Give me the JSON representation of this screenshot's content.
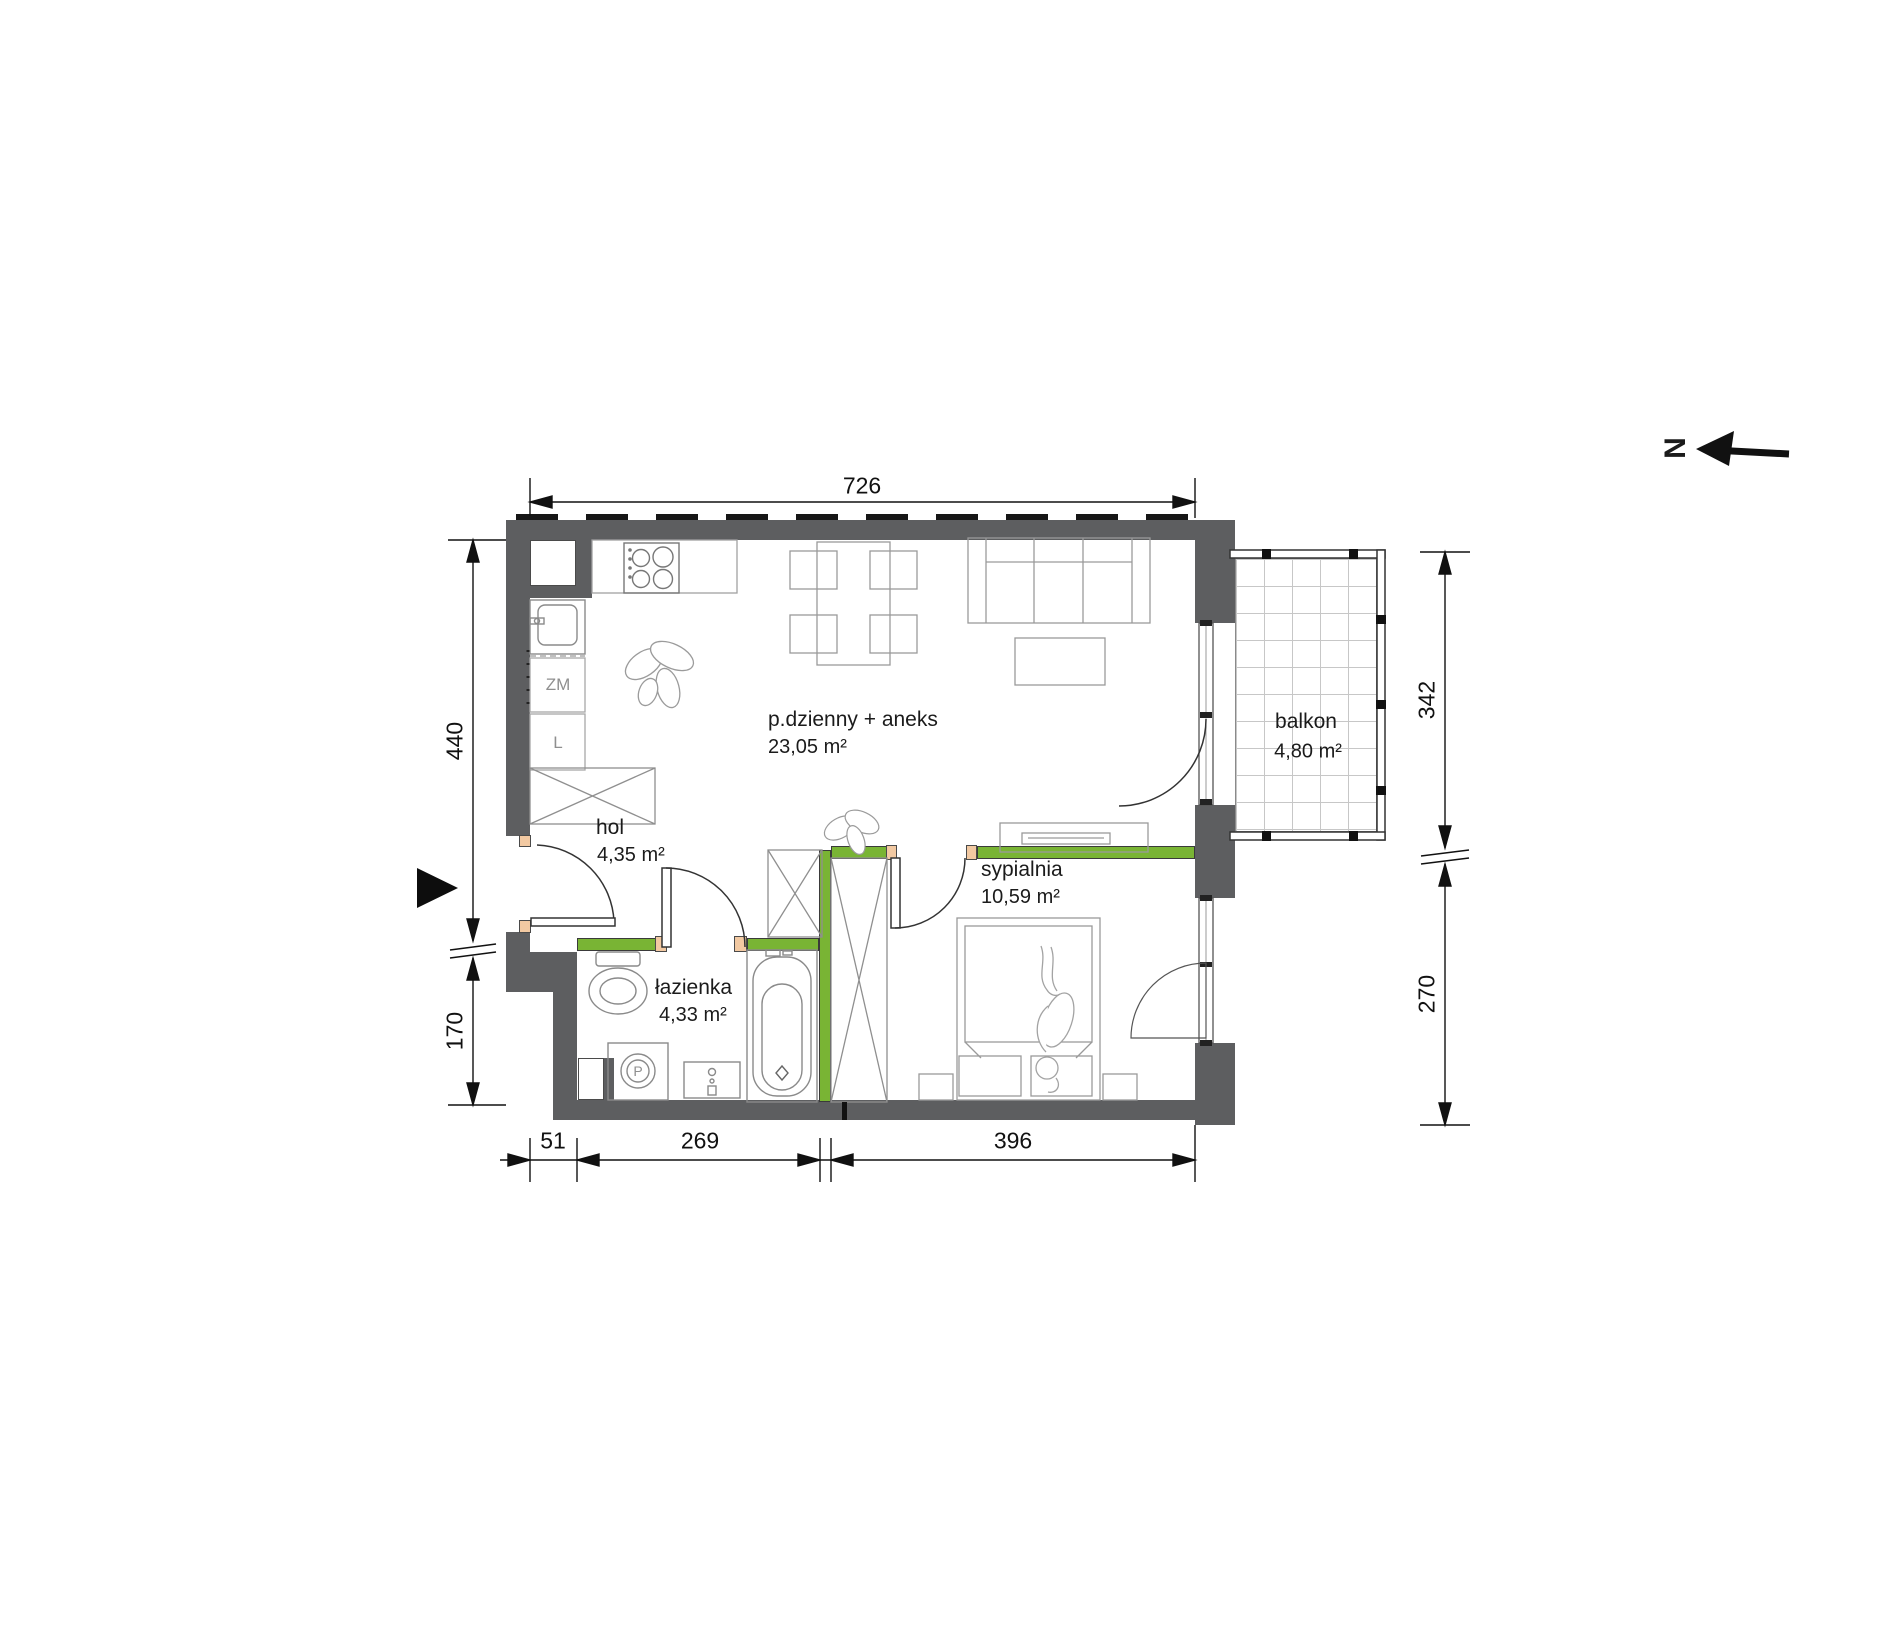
{
  "compass": {
    "north": "N"
  },
  "rooms": [
    {
      "id": "living",
      "name": "p.dzienny + aneks",
      "area": "23,05 m²"
    },
    {
      "id": "hall",
      "name": "hol",
      "area": "4,35 m²"
    },
    {
      "id": "bathroom",
      "name": "łazienka",
      "area": "4,33 m²"
    },
    {
      "id": "bedroom",
      "name": "sypialnia",
      "area": "10,59 m²"
    },
    {
      "id": "balcony",
      "name": "balkon",
      "area": "4,80 m²"
    }
  ],
  "dimensions_cm": {
    "top_width": "726",
    "left_upper": "440",
    "left_lower": "170",
    "bottom_offset": "51",
    "bottom_bathroom": "269",
    "bottom_bedroom": "396",
    "right_balcony": "342",
    "right_bedroom": "270"
  },
  "appliances": {
    "dishwasher_label": "ZM",
    "fridge_label": "L",
    "washer_label": "P"
  },
  "colors": {
    "wall_gray": "#5d5e60",
    "partition_green": "#79b434",
    "door_jamb_tan": "#f2c9a2"
  }
}
